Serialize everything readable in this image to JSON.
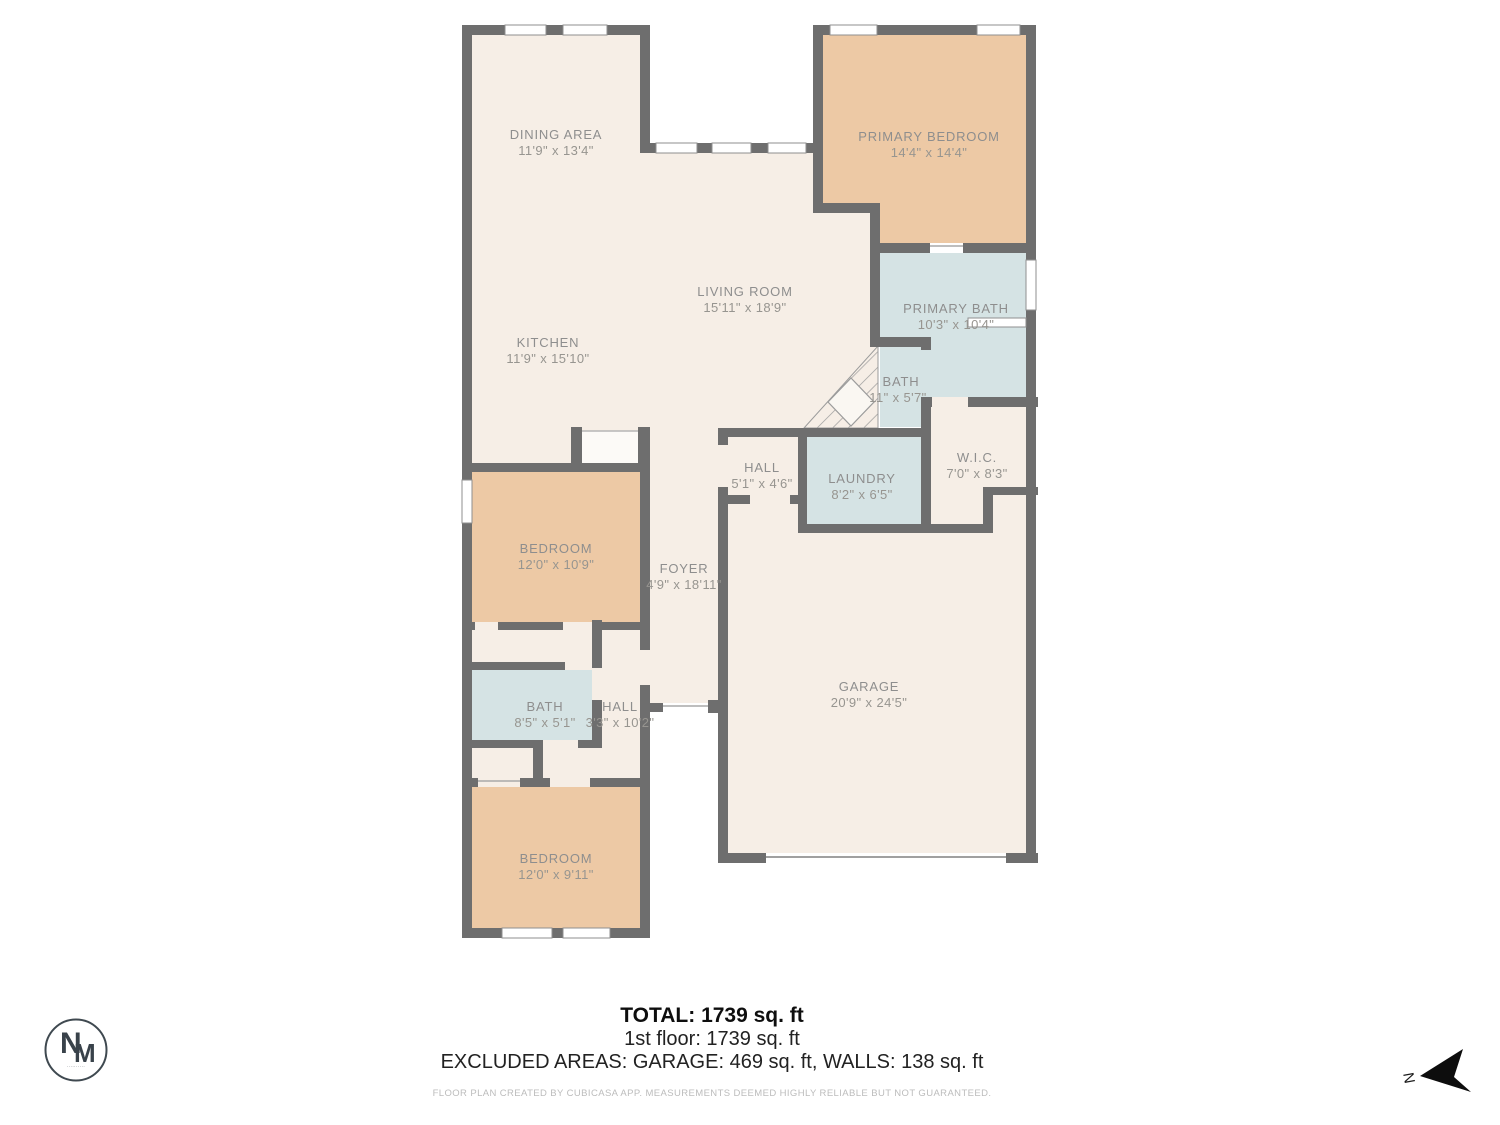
{
  "plan": {
    "rooms": [
      {
        "name": "DINING AREA",
        "dims": "11'9\" x 13'4\""
      },
      {
        "name": "PRIMARY BEDROOM",
        "dims": "14'4\" x 14'4\""
      },
      {
        "name": "LIVING ROOM",
        "dims": "15'11\" x 18'9\""
      },
      {
        "name": "KITCHEN",
        "dims": "11'9\" x 15'10\""
      },
      {
        "name": "PRIMARY BATH",
        "dims": "10'3\" x 10'4\""
      },
      {
        "name": "BATH",
        "dims": "11\" x 5'7\""
      },
      {
        "name": "HALL",
        "dims": "5'1\" x 4'6\""
      },
      {
        "name": "LAUNDRY",
        "dims": "8'2\" x 6'5\""
      },
      {
        "name": "W.I.C.",
        "dims": "7'0\" x 8'3\""
      },
      {
        "name": "BEDROOM",
        "dims": "12'0\" x 10'9\""
      },
      {
        "name": "FOYER",
        "dims": "4'9\" x 18'11\""
      },
      {
        "name": "GARAGE",
        "dims": "20'9\" x 24'5\""
      },
      {
        "name": "BATH",
        "dims": "8'5\" x 5'1\""
      },
      {
        "name": "HALL",
        "dims": "3'3\" x 10'2\""
      },
      {
        "name": "BEDROOM",
        "dims": "12'0\" x 9'11\""
      }
    ],
    "north_label": "N",
    "colors": {
      "wall": "#6e6e6e",
      "floor": "#f6eee6",
      "warm_room": "#edc9a5",
      "wet_room": "#d5e3e4",
      "label_text": "#8e8e8e"
    }
  },
  "footer": {
    "total_line": "TOTAL: 1739 sq. ft",
    "floor_line": "1st floor: 1739 sq. ft",
    "excluded_line": "EXCLUDED AREAS: GARAGE: 469 sq. ft, WALLS: 138 sq. ft",
    "disclaimer": "FLOOR PLAN CREATED BY CUBICASA APP. MEASUREMENTS DEEMED HIGHLY RELIABLE BUT NOT GUARANTEED."
  },
  "logo": {
    "monogram_top": "N",
    "monogram_bottom": "M",
    "tagline": "··········"
  }
}
